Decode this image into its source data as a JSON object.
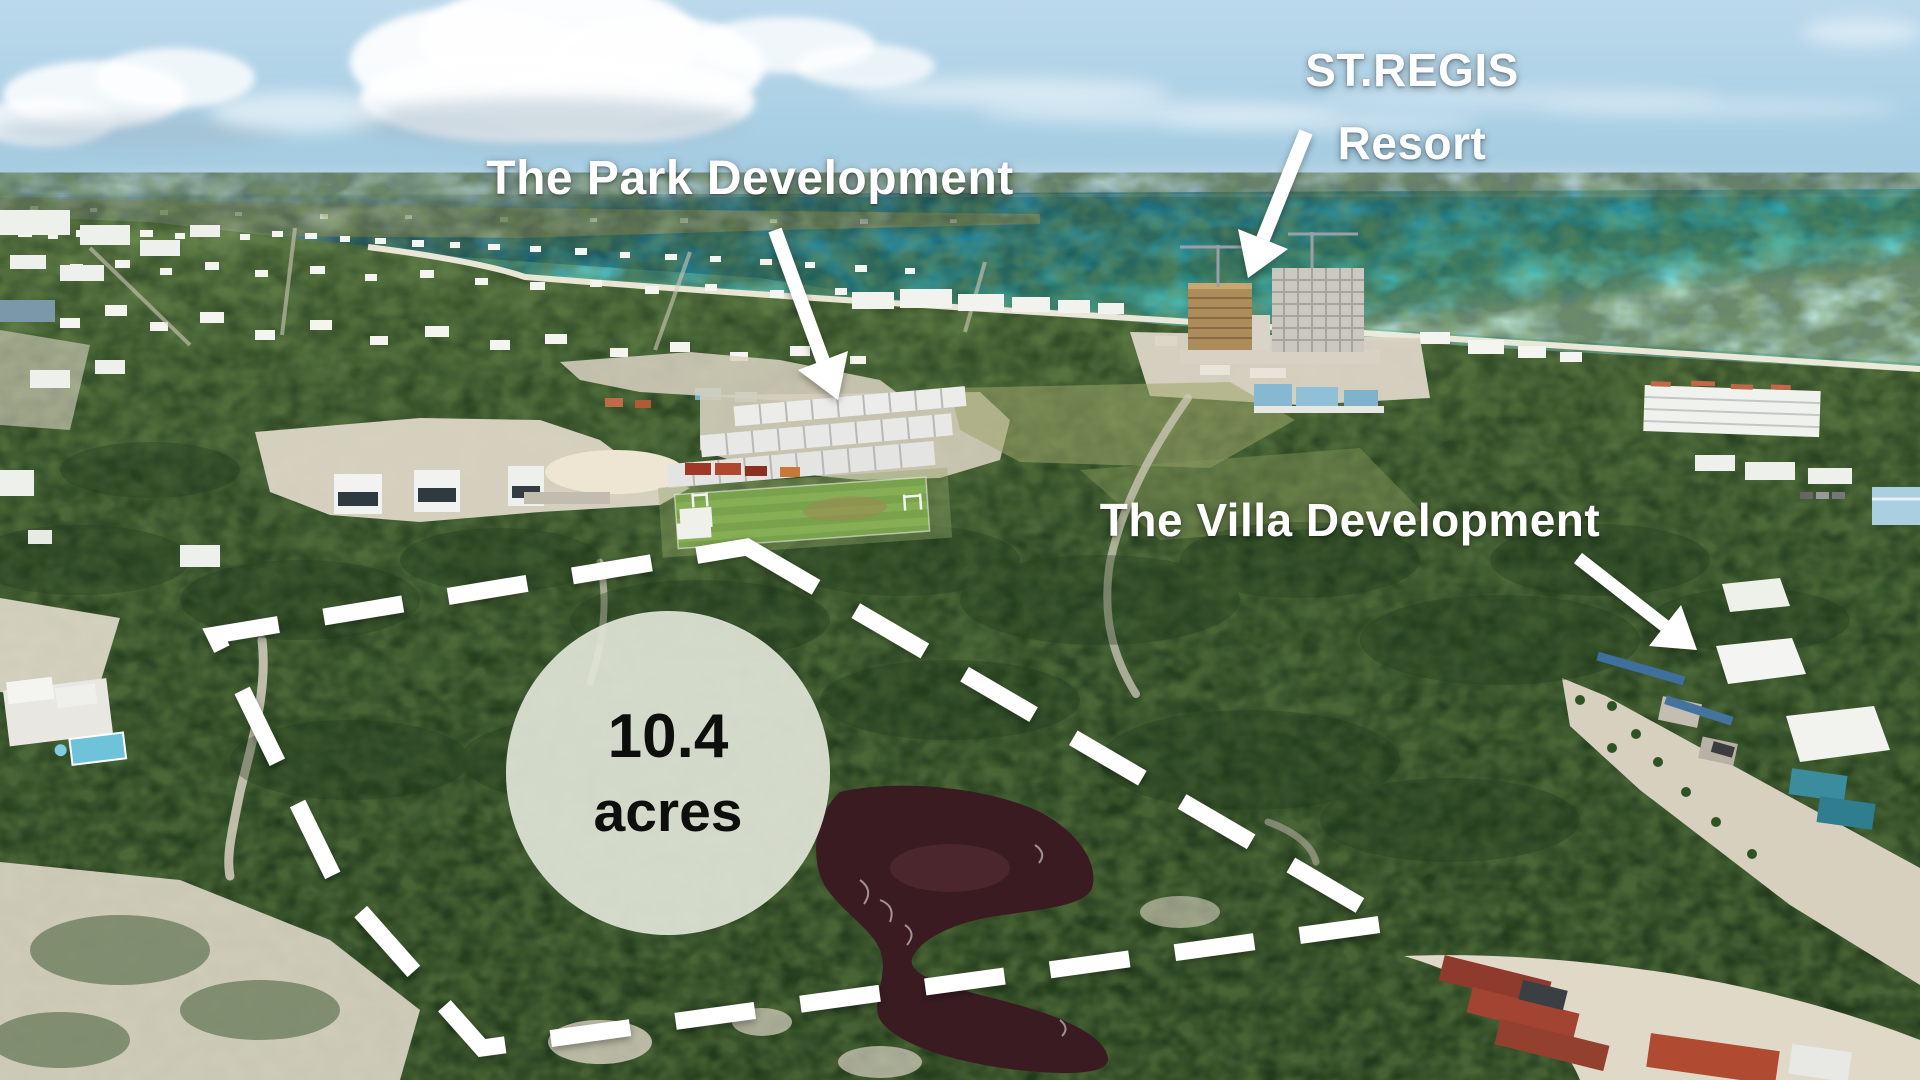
{
  "annotations": {
    "park_label": "The Park Development",
    "stregis_line1": "ST.REGIS",
    "stregis_line2": "Resort",
    "villa_label": "The Villa Development",
    "parcel_area_value": "10.4",
    "parcel_area_unit": "acres"
  },
  "colors": {
    "annotation_text": "#ffffff",
    "parcel_outline": "#ffffff",
    "badge_background": "#e0e4d6",
    "badge_text": "#0e0e0c",
    "ocean_deep": "#1f84ac",
    "ocean_turquoise": "#2aaebf",
    "shallow_cyan": "#5ed2d4",
    "vegetation": "#33522b",
    "sand": "#ddd6c6",
    "pond": "#3a1b22",
    "container_red": "#a34432"
  }
}
